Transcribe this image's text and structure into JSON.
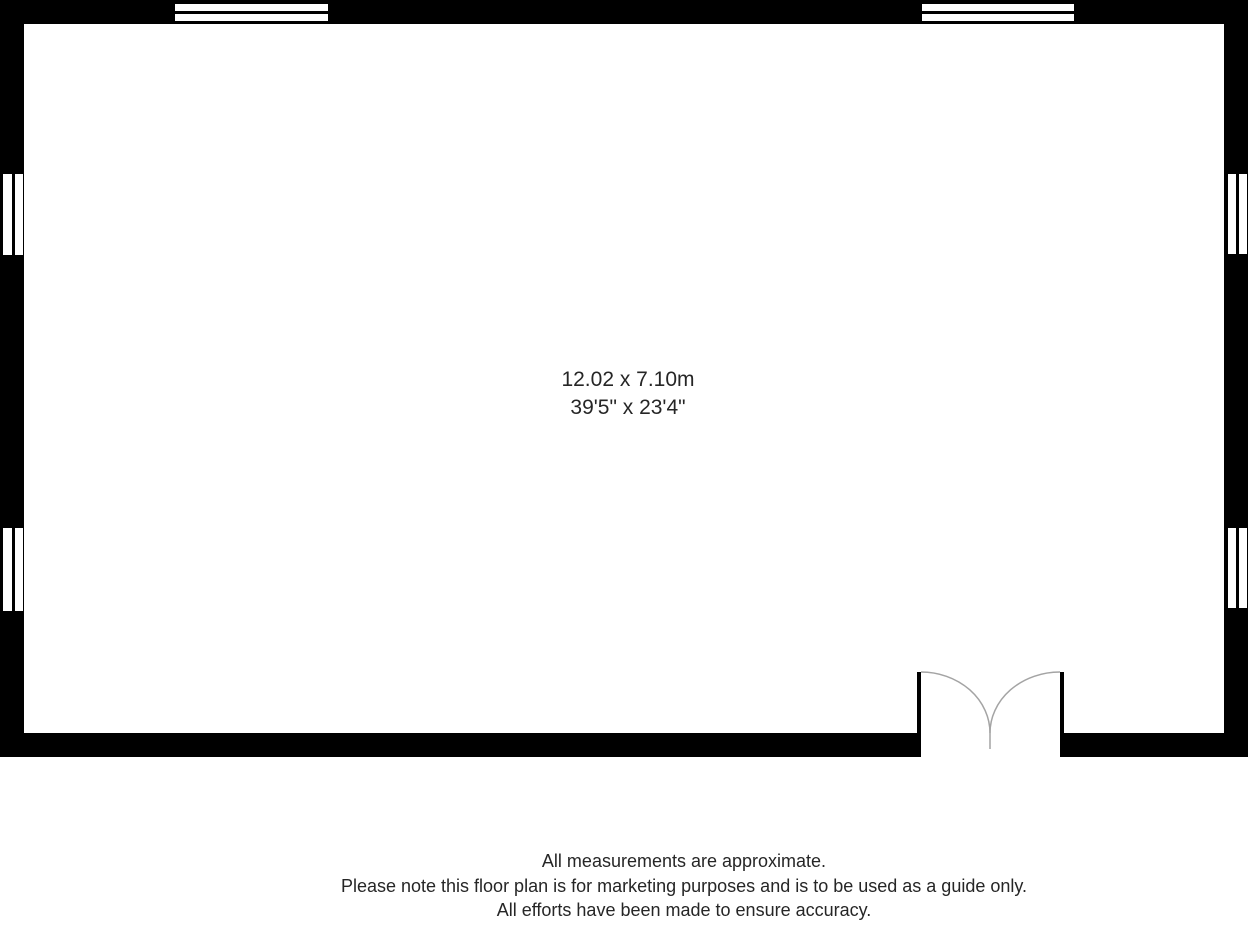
{
  "room_label": {
    "metric": "12.02 x 7.10m",
    "imperial": "39'5\" x 23'4\""
  },
  "disclaimer": {
    "lines": [
      "All measurements are approximate.",
      "Please note this floor plan is for marketing purposes and is to be used as a guide only.",
      "All efforts have been made to ensure accuracy."
    ]
  },
  "colors": {
    "wall": "#000000",
    "door_arc": "#a4a4a4",
    "text": "#262626",
    "background": "#ffffff"
  }
}
